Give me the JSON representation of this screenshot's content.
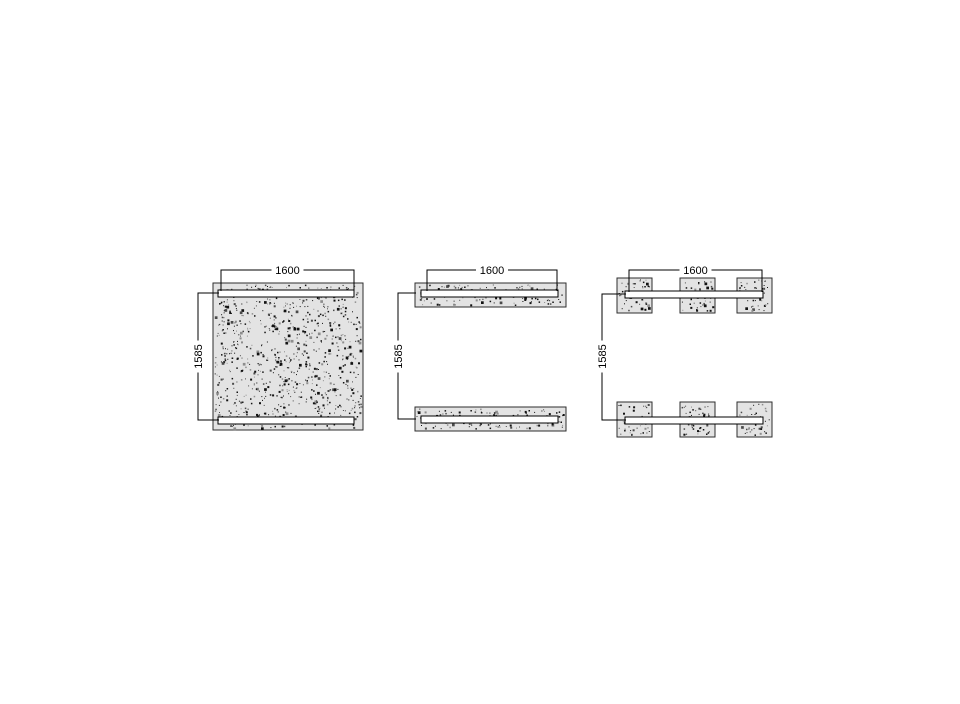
{
  "page": {
    "background": "#ffffff",
    "description": "technical drawing of three precast panel variants with dimensions"
  },
  "colors": {
    "panel_fill": "#e3e3e3",
    "panel_outline": "#2e2e2e",
    "slot_fill": "#ffffff",
    "slot_outline": "#000000",
    "dimension_line": "#000000",
    "label_text": "#000000",
    "speckle_dark": "#121212",
    "speckle_mid": "#4a4a4a",
    "speckle_light": "#8d8d8d"
  },
  "figures": [
    {
      "name": "solid-panel",
      "width_dim": "1600",
      "height_dim": "1585"
    },
    {
      "name": "top-bottom-strip-panel",
      "width_dim": "1600",
      "height_dim": "1585"
    },
    {
      "name": "six-pad-panel",
      "width_dim": "1600",
      "height_dim": "1585"
    }
  ]
}
